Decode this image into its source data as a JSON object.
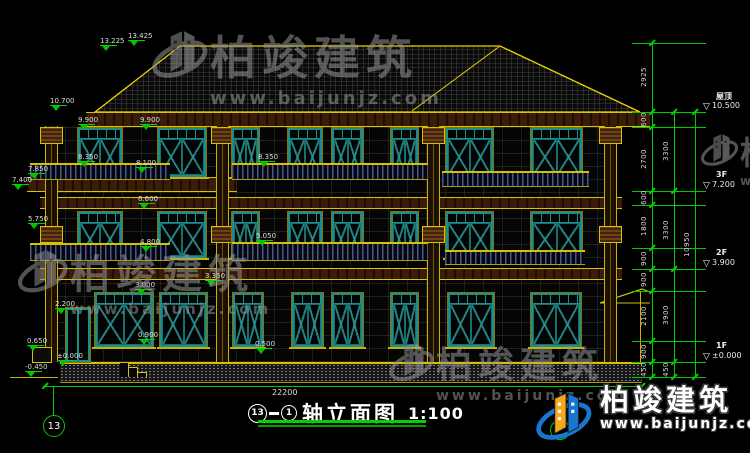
{
  "drawing": {
    "title": {
      "axis_start": "13",
      "axis_end": "1",
      "name": "轴立面图",
      "scale": "1:100"
    },
    "axis_bubble": "13",
    "total_width_dim": "22200",
    "elevation_markers": [
      "13.425",
      "13.225",
      "10.700",
      "9.900",
      "9.900",
      "8.350",
      "8.100",
      "7.850",
      "7.400",
      "6.600",
      "5.750",
      "8.350",
      "5.050",
      "4.800",
      "3.350",
      "3.000",
      "2.200",
      "0.900",
      "0.650",
      "0.500",
      "±0.000",
      "-0.450"
    ],
    "right_dims": {
      "chain_a": [
        "2925",
        "600",
        "2700",
        "600",
        "1800",
        "900",
        "900",
        "2100",
        "900",
        "450"
      ],
      "chain_b": [
        "3300",
        "3300",
        "3900",
        "450"
      ],
      "chain_c": [
        "10950"
      ],
      "levels": [
        {
          "name": "屋顶",
          "elev": "10.500"
        },
        {
          "name": "3F",
          "elev": "7.200"
        },
        {
          "name": "2F",
          "elev": "3.900"
        },
        {
          "name": "1F",
          "elev": "±0.000"
        }
      ]
    }
  },
  "watermark": {
    "brand": "柏竣建筑",
    "url": "www.baijunjz.com"
  },
  "logo": {
    "brand": "柏竣建筑",
    "url": "www.baijunjz.com"
  },
  "colors": {
    "dim_green": "#00cc00",
    "line_yellow": "#d8c200",
    "window_teal": "#1f8c8c",
    "wood_brown": "#3a1c08",
    "logo_blue": "#1677d2",
    "logo_orange": "#f6a81c"
  }
}
